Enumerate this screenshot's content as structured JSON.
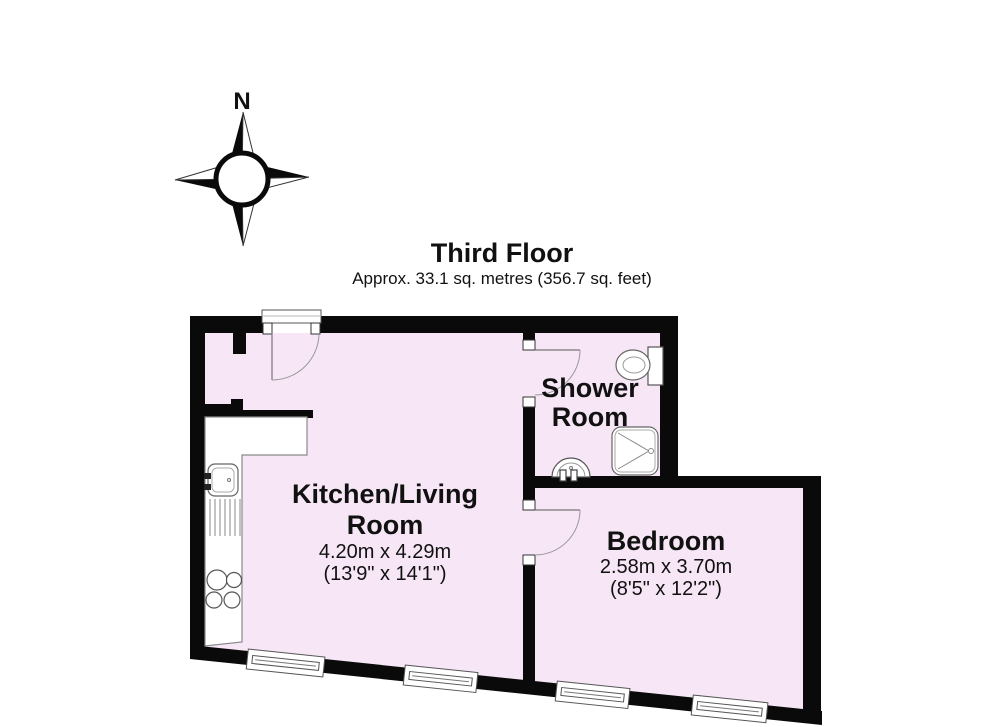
{
  "title": {
    "heading": "Third Floor",
    "subheading": "Approx. 33.1 sq. metres (356.7 sq. feet)"
  },
  "compass": {
    "north_label": "N"
  },
  "rooms": {
    "kitchen_living": {
      "name_line1": "Kitchen/Living",
      "name_line2": "Room",
      "dimensions_metric": "4.20m x 4.29m",
      "dimensions_imperial": "(13'9\" x 14'1\")"
    },
    "shower": {
      "name_line1": "Shower",
      "name_line2": "Room"
    },
    "bedroom": {
      "name": "Bedroom",
      "dimensions_metric": "2.58m x 3.70m",
      "dimensions_imperial": "(8'5\" x 12'2\")"
    }
  },
  "colors": {
    "floor_fill": "#f7e7f6",
    "wall": "#0a0a0a",
    "fixture_stroke": "#666666",
    "fixture_stroke_light": "#999999",
    "door_stroke": "#777777",
    "text": "#111111"
  }
}
